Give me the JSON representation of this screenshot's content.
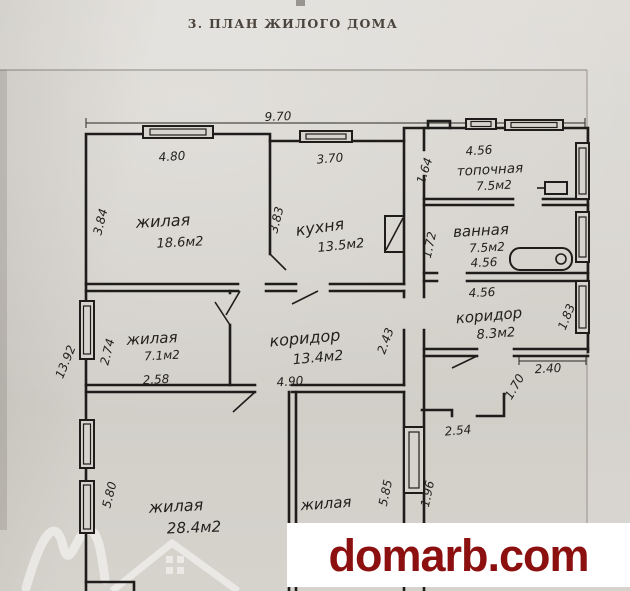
{
  "page": {
    "title": "3. ПЛАН ЖИЛОГО ДОМА"
  },
  "plan": {
    "type": "floor-plan",
    "units": "м",
    "overall_width": "9.70",
    "overall_height": "13.92",
    "rooms": [
      {
        "name": "жилая",
        "area": "18.6м2",
        "width": "4.80",
        "depth": "3.84"
      },
      {
        "name": "кухня",
        "area": "13.5м2",
        "width": "3.70",
        "depth": "3.83"
      },
      {
        "name": "топочная",
        "area": "7.5м2",
        "width": "4.56",
        "depth": "1.64"
      },
      {
        "name": "ванная",
        "area": "7.5м2",
        "width": "4.56",
        "depth": "1.72"
      },
      {
        "name": "коридор",
        "area": "8.3м2",
        "width": "4.56",
        "depth": "1.83"
      },
      {
        "name": "жилая",
        "area": "7.1м2",
        "width": "2.58",
        "depth": "2.74"
      },
      {
        "name": "коридор",
        "area": "13.4м2",
        "width": "4.90",
        "depth": "2.43"
      },
      {
        "name": "жилая",
        "area": "28.4м2",
        "depth": "5.80"
      },
      {
        "name": "жилая",
        "depth": "5.85"
      }
    ],
    "extra_dimensions": [
      "4.56",
      "2.40",
      "1.70",
      "1.96",
      "2.54"
    ],
    "fixtures": [
      "bathtub",
      "boiler",
      "stove",
      "windows"
    ],
    "labels": [
      "9.70",
      "4.80",
      "3.84",
      "жилая",
      "18.6м2",
      "3.70",
      "3.83",
      "кухня",
      "13.5м2",
      "1.64",
      "4.56",
      "топочная",
      "7.5м2",
      "1.72",
      "ванная",
      "7.5м2",
      "4.56",
      "4.56",
      "коридор",
      "8.3м2",
      "1.83",
      "2.40",
      "1.70",
      "жилая",
      "7.1м2",
      "2.74",
      "2.58",
      "коридор",
      "13.4м2",
      "2.43",
      "4.90",
      "13.92",
      "5.80",
      "жилая",
      "28.4м2",
      "жилая",
      "5.85",
      "1.96",
      "2.54"
    ]
  },
  "watermark": {
    "site": "domarb.com",
    "text_color": "#8c1010",
    "background": "#ffffff",
    "logo": "house-logo"
  },
  "colors": {
    "paper": "#d6d3ce",
    "ink": "#23211e"
  }
}
